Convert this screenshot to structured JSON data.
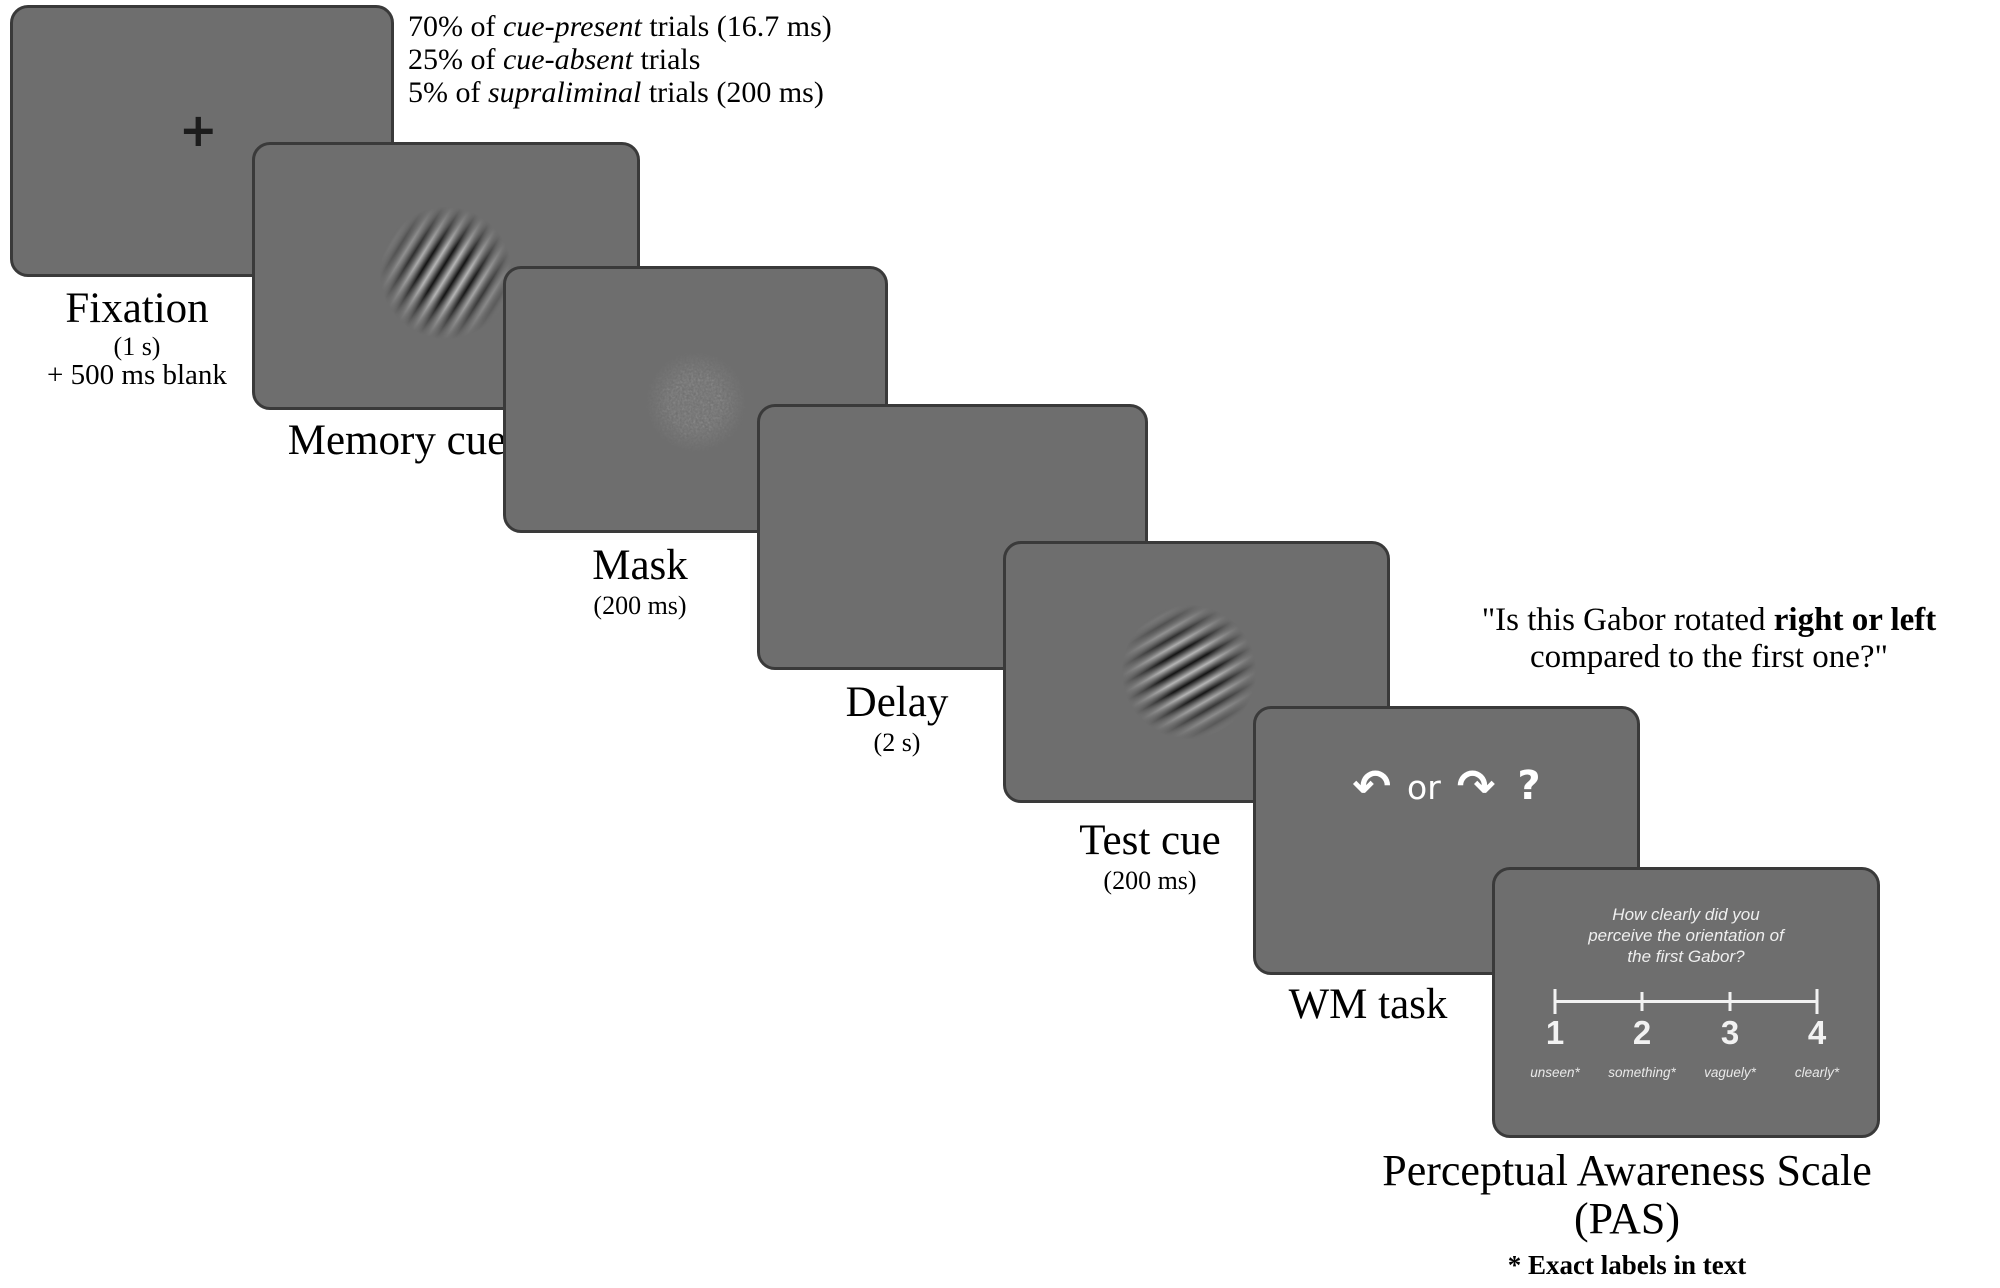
{
  "colors": {
    "page_bg": "#ffffff",
    "panel_fill": "#6e6e6e",
    "panel_border": "#3a3a3a",
    "panel_text": "#f2f2f2",
    "caption_text": "#000000"
  },
  "trial_info": {
    "line1_pre": "70% of ",
    "line1_italic": "cue-present",
    "line1_post": " trials (16.7 ms)",
    "line2_pre": "25% of ",
    "line2_italic": "cue-absent",
    "line2_post": " trials",
    "line3_pre": "5% of ",
    "line3_italic": "supraliminal",
    "line3_post": " trials (200 ms)"
  },
  "question": {
    "line1_pre": "\"Is this Gabor rotated ",
    "line1_bold": "right or left",
    "line2": "compared to the first one?\""
  },
  "panels": [
    {
      "name": "fixation",
      "label": "Fixation",
      "duration": "(1 s)",
      "extra": "+ 500 ms blank",
      "cross": "+"
    },
    {
      "name": "memory-cue",
      "label": "Memory cue"
    },
    {
      "name": "mask",
      "label": "Mask",
      "duration": "(200 ms)"
    },
    {
      "name": "delay",
      "label": "Delay",
      "duration": "(2 s)"
    },
    {
      "name": "test-cue",
      "label": "Test cue",
      "duration": "(200 ms)"
    },
    {
      "name": "wm-task",
      "label": "WM task",
      "left_arrow": "↶",
      "or_text": "or",
      "right_arrow": "↷",
      "question_mark": "?"
    },
    {
      "name": "pas",
      "question_line1": "How clearly did you",
      "question_line2": "perceive the orientation of",
      "question_line3": "the first Gabor?",
      "scale_points": [
        {
          "number": "1",
          "label": "unseen*"
        },
        {
          "number": "2",
          "label": "something*"
        },
        {
          "number": "3",
          "label": "vaguely*"
        },
        {
          "number": "4",
          "label": "clearly*"
        }
      ]
    }
  ],
  "pas_caption": {
    "title": "Perceptual Awareness Scale",
    "subtitle": "(PAS)",
    "footnote": "* Exact labels in text"
  }
}
